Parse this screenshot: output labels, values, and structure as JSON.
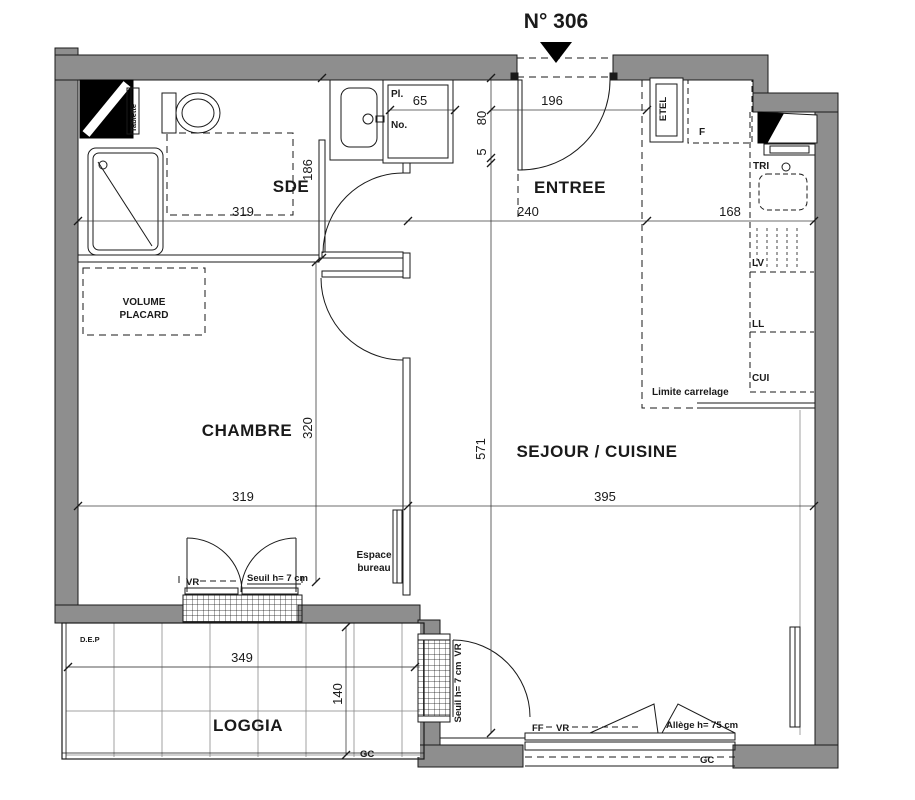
{
  "unit": {
    "label": "N° 306"
  },
  "rooms": {
    "sde": "SDE",
    "entree": "ENTREE",
    "chambre": "CHAMBRE",
    "sejour_cuisine": "SEJOUR / CUISINE",
    "loggia": "LOGGIA"
  },
  "fixtures": {
    "tablette": "Tablette",
    "placard_top": "Pl.",
    "placard_bottom": "No.",
    "etel": "ETEL",
    "fridge": "F",
    "tri": "TRI",
    "lave_vaisselle": "LV",
    "lave_linge": "LL",
    "cuisiniere": "CUI",
    "limite_carrelage": "Limite carrelage",
    "volume_placard_line1": "VOLUME",
    "volume_placard_line2": "PLACARD",
    "espace_bureau_line1": "Espace",
    "espace_bureau_line2": "bureau",
    "dep": "D.E.P"
  },
  "openings": {
    "vr_chambre": "VR",
    "seuil_chambre": "Seuil h= 7 cm",
    "vr_loggia": "VR",
    "seuil_loggia": "Seuil h= 7 cm",
    "ff_sejour": "FF",
    "vr_sejour": "VR",
    "allege": "Allège h= 75 cm",
    "gc_loggia": "GC",
    "gc_sejour": "GC"
  },
  "dimensions": {
    "sde_width": "319",
    "sde_depth": "186",
    "placard_width": "65",
    "entry_width": "196",
    "wall_a": "80",
    "wall_b": "5",
    "entree_width": "240",
    "kitchen_width": "168",
    "chambre_width": "319",
    "chambre_depth": "320",
    "sejour_depth": "571",
    "sejour_width": "395",
    "loggia_width": "349",
    "loggia_depth": "140"
  }
}
